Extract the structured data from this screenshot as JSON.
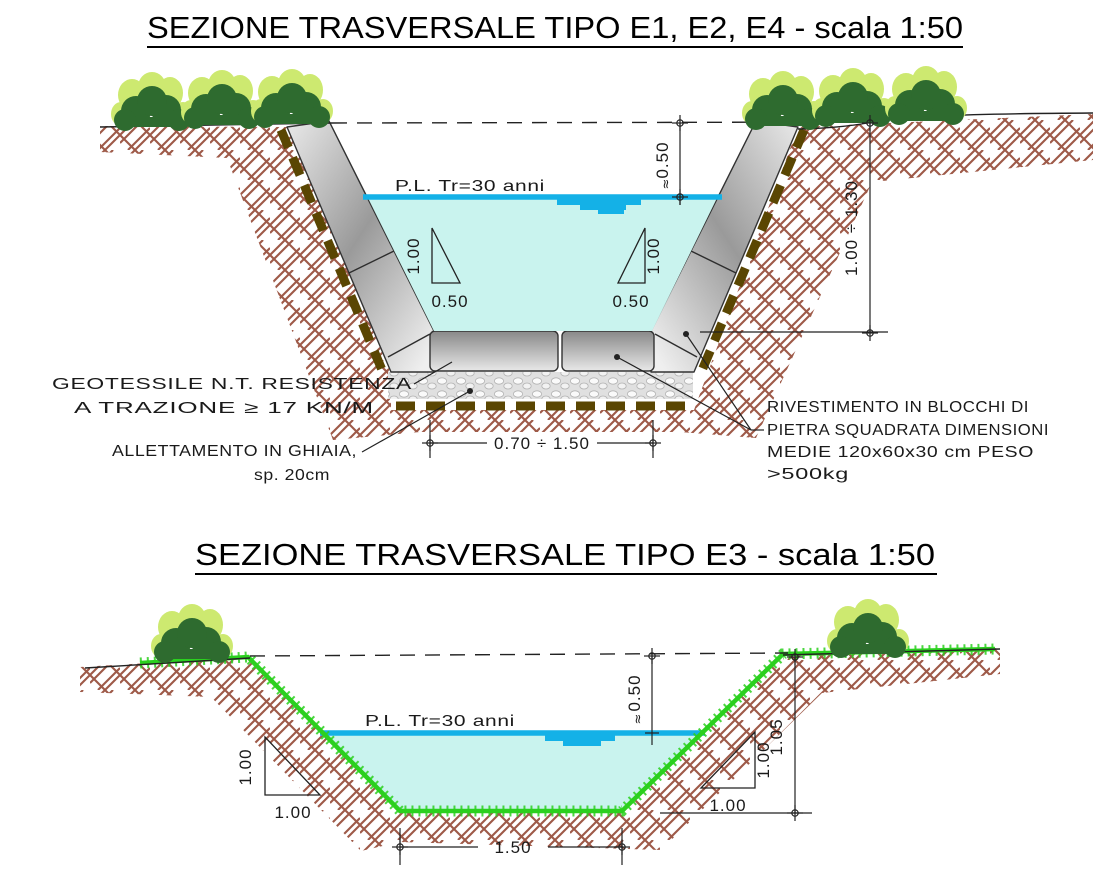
{
  "s1": {
    "title": "SEZIONE TRASVERSALE TIPO E1, E2, E4 - scala 1:50",
    "water_level_label": "P.L. Tr=30 anni",
    "dim_freeboard": "0.50",
    "approx_symbol": "≈",
    "dim_depth": "1.00 ÷ 1.30",
    "dim_bottom_width": "0.70 ÷ 1.50",
    "slope_rise": "1.00",
    "slope_run": "0.50",
    "note_geotextile": [
      "GEOTESSILE N.T. RESISTENZA",
      "A TRAZIONE ≥ 17 KN/M"
    ],
    "note_bedding": [
      "ALLETTAMENTO IN GHIAIA,",
      "sp. 20cm"
    ],
    "note_revetment": [
      "RIVESTIMENTO IN BLOCCHI DI",
      "PIETRA SQUADRATA DIMENSIONI",
      "MEDIE 120x60x30 cm PESO",
      ">500kg"
    ]
  },
  "s2": {
    "title": "SEZIONE TRASVERSALE TIPO E3 - scala 1:50",
    "water_level_label": "P.L. Tr=30 anni",
    "dim_freeboard": "0.50",
    "approx_symbol": "≈",
    "dim_depth": "1.05",
    "dim_bottom_width": "1.50",
    "slope_rise": "1.00",
    "slope_run": "1.00"
  },
  "colors": {
    "water_fill": "#c9f3ee",
    "water_line": "#14b1e7",
    "soil_hatch": "#9e5a48",
    "geotextile": "#5a4602",
    "grass": "#2bd01f",
    "bush_dark": "#2e6b2f",
    "bush_light": "#cde970",
    "stone_dark": "#6f6f6f",
    "stone_light": "#efefef",
    "line": "#1a1a1a"
  }
}
